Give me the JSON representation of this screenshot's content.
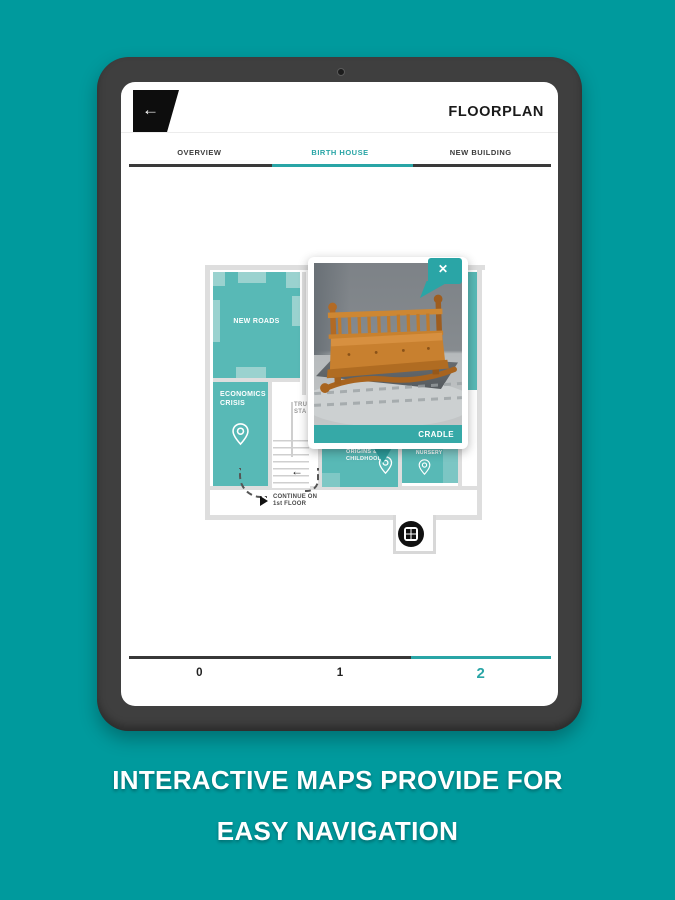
{
  "header": {
    "title": "FLOORPLAN",
    "back_icon": "←"
  },
  "tabs": {
    "items": [
      {
        "label": "OVERVIEW",
        "active": false
      },
      {
        "label": "BIRTH HOUSE",
        "active": true
      },
      {
        "label": "NEW BUILDING",
        "active": false
      }
    ]
  },
  "map": {
    "rooms": [
      {
        "id": "new-roads",
        "label": "NEW ROADS"
      },
      {
        "id": "economics-crisis",
        "line1": "ECONOMICS",
        "line2": "CRISIS"
      },
      {
        "id": "origins-childhood",
        "line1": "ORIGINS &",
        "line2": "CHILDHOOD"
      },
      {
        "id": "nursery",
        "label": "NURSERY"
      }
    ],
    "stairs_label": {
      "line1": "TRU",
      "line2": "STA"
    },
    "continue_note": {
      "line1": "CONTINUE ON",
      "line2": "1st FLOOR"
    },
    "markers": [
      "economics-pin",
      "origins-pin",
      "nursery-pin",
      "elevator-marker"
    ]
  },
  "popup": {
    "title": "CRADLE",
    "close_label": "✕",
    "image_subject": "wooden cradle in museum room"
  },
  "pager": {
    "items": [
      "0",
      "1",
      "2"
    ],
    "active": "2"
  },
  "caption": {
    "line1": "INTERACTIVE MAPS PROVIDE FOR",
    "line2": "EASY NAVIGATION"
  },
  "colors": {
    "background": "#009a9d",
    "accent": "#29a5a6",
    "room_teal": "#58b9b6",
    "room_light": "#9ad2cf",
    "popup_bar": "#36a9a7",
    "wall_gray": "#dedede",
    "bezel": "#3f3f3f"
  }
}
